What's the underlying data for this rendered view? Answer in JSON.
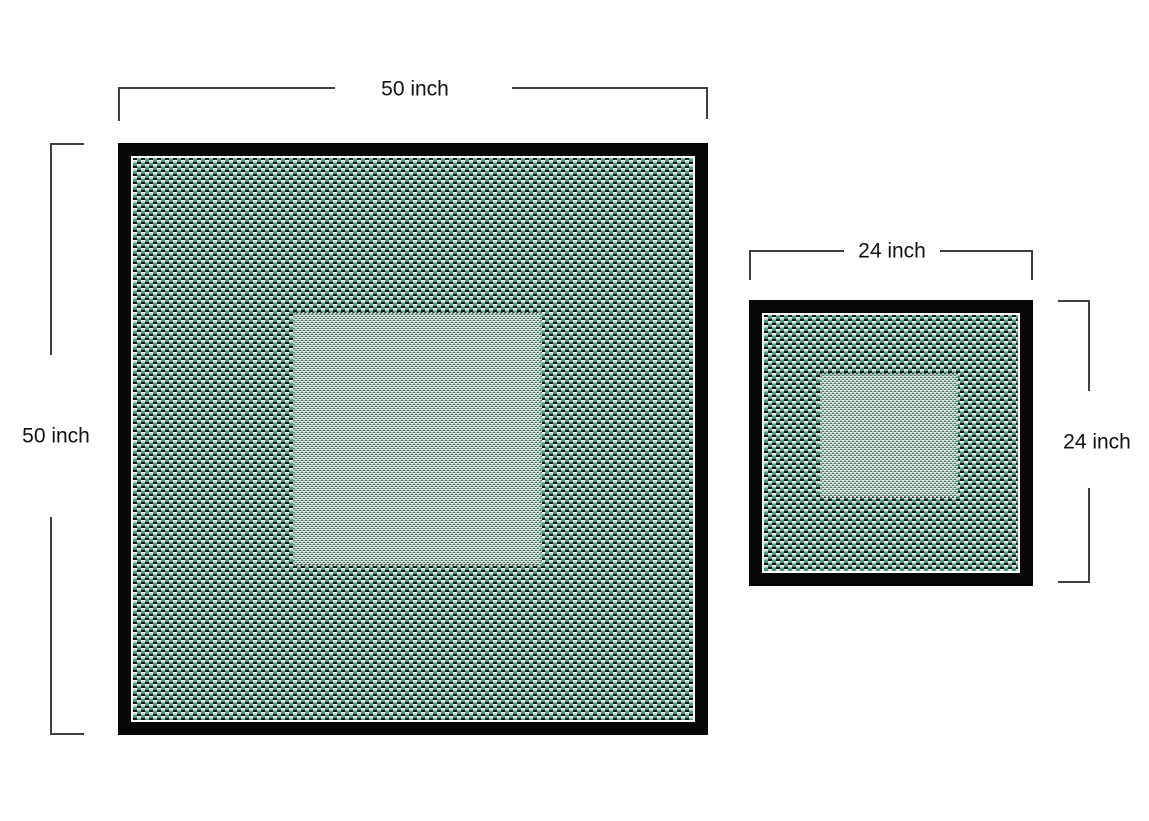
{
  "diagram": {
    "background": "#ffffff",
    "type": "dimensioned-size-comparison",
    "units": "inch"
  },
  "mats": {
    "large": {
      "width_label": "50 inch",
      "height_label": "50 inch",
      "width_in": 50,
      "height_in": 50
    },
    "small": {
      "width_label": "24 inch",
      "height_label": "24 inch",
      "width_in": 24,
      "height_in": 24
    }
  },
  "colors": {
    "background": "#ffffff",
    "frame": "#060606",
    "weave_green": "#4f9c80",
    "weave_white": "#f4f8f5",
    "weave_black": "#161616",
    "fine_green": "#aecfc0",
    "fine_white": "#f2f6f3",
    "fine_dark": "#4d6f62",
    "dim_line": "#3f3f3f",
    "label_text": "#111111"
  }
}
